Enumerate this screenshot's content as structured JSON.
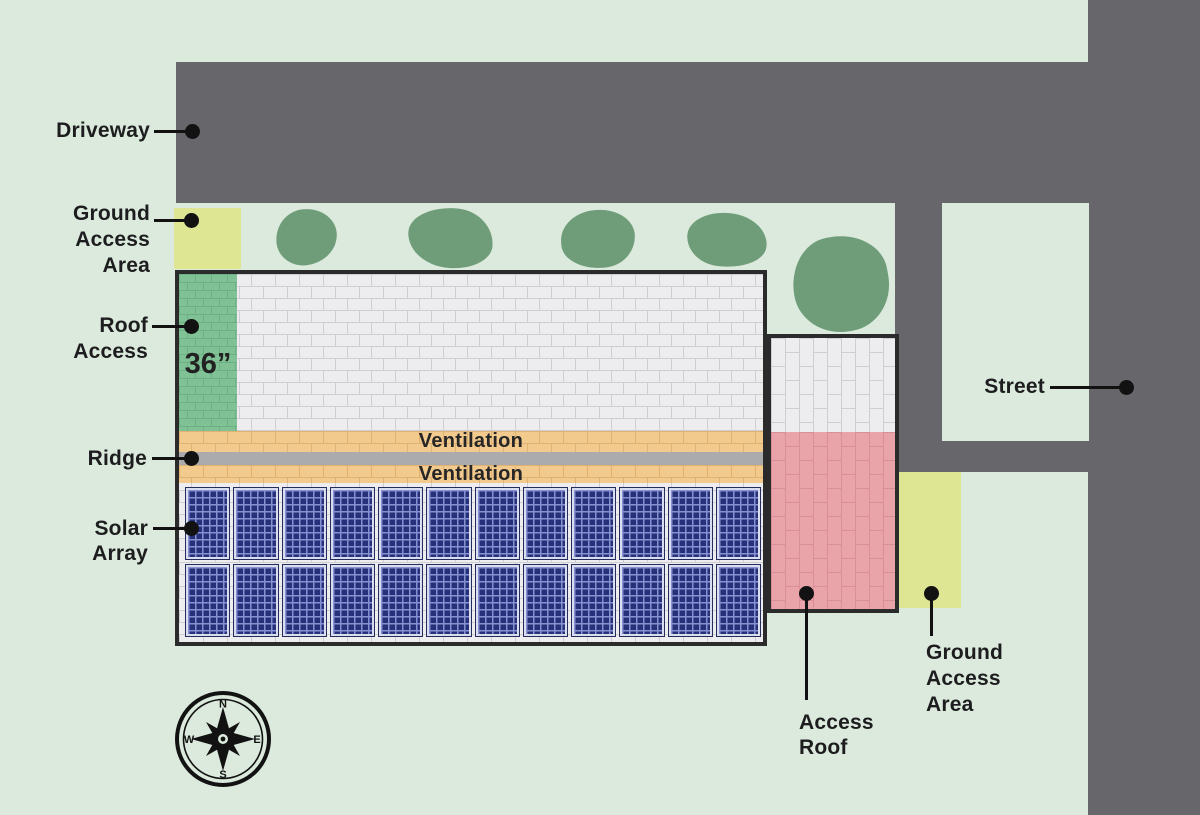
{
  "title": "Rooftop solar access site plan",
  "colors": {
    "bg": "#dbeadc",
    "road": "#67676b",
    "bush": "#6f9d7a",
    "access_yellow": "#dee694",
    "border_dark": "#2b2b2b",
    "brick_white": "#ededef",
    "brick_white_mortar": "#cdcdd2",
    "green_strip": "#80c296",
    "green_strip_mortar": "#6cb083",
    "vent_orange": "#f2ca8e",
    "vent_orange_mortar": "#e0b272",
    "ridge_gray": "#ababad",
    "pink": "#e9a4aa",
    "pink_mortar": "#da8f98",
    "panel_cell": "#27317a",
    "panel_grid": "#8791d2",
    "panel_frame": "#d9ddee",
    "panel_border": "#242e5e",
    "ink": "#1d1d1f"
  },
  "labels": {
    "driveway": "Driveway",
    "ground_access_left": {
      "lines": [
        "Ground",
        "Access",
        "Area"
      ]
    },
    "roof_access": {
      "lines": [
        "Roof",
        "Access"
      ]
    },
    "ridge": "Ridge",
    "solar_array": {
      "lines": [
        "Solar",
        "Array"
      ]
    },
    "street": "Street",
    "access_roof": {
      "lines": [
        "Access",
        "Roof"
      ]
    },
    "ground_access_right": {
      "lines": [
        "Ground",
        "Access",
        "Area"
      ]
    }
  },
  "roof": {
    "setback_width": "36”",
    "ventilation_label": "Ventilation"
  },
  "solar_array": {
    "columns": 12,
    "rows": 2
  },
  "compass": {
    "n": "N",
    "e": "E",
    "s": "S",
    "w": "W"
  }
}
